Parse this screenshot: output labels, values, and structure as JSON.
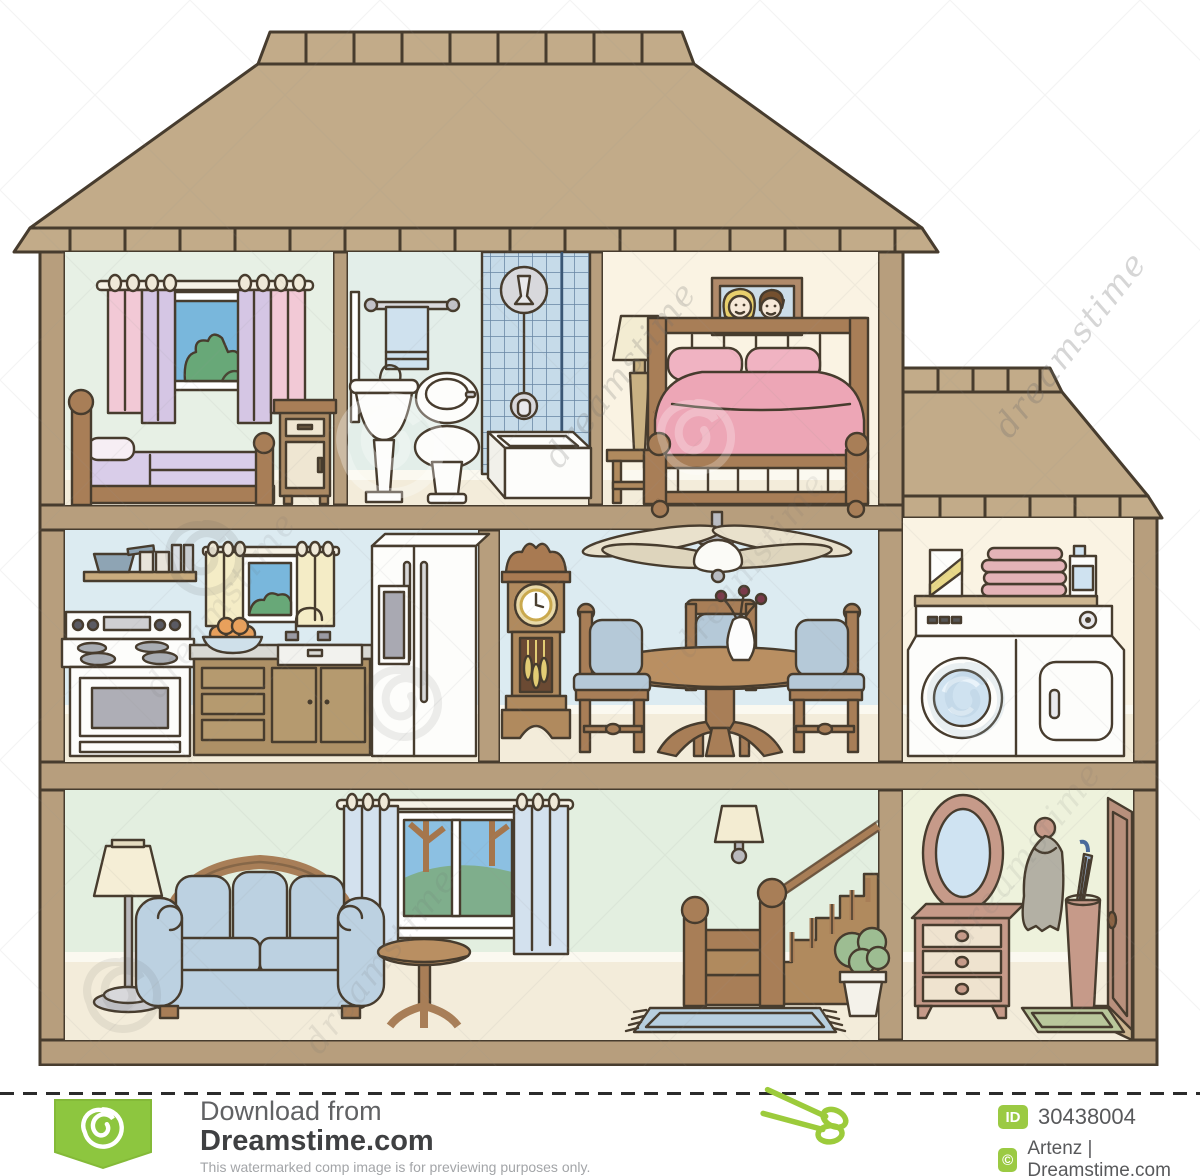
{
  "watermark": {
    "brand": "dreamstime",
    "logo": "spiral-swirl"
  },
  "footer": {
    "download_from": "Download from",
    "site": "Dreamstime.com",
    "disclaimer": "This watermarked comp image is for previewing purposes only.",
    "id_badge": "ID",
    "image_id": "30438004",
    "copyright_badge": "©",
    "credit": "Artenz | Dreamstime.com"
  },
  "illustration": {
    "subject": "house cross-section",
    "rooms": [
      {
        "name": "child-bedroom",
        "floor": "top",
        "items": [
          "window-with-curtains",
          "single-bed",
          "nightstand"
        ]
      },
      {
        "name": "bathroom",
        "floor": "top",
        "items": [
          "towel-rail",
          "pedestal-sink",
          "toilet",
          "shower",
          "bathtub"
        ]
      },
      {
        "name": "master-bedroom",
        "floor": "top",
        "items": [
          "portrait",
          "table-lamp",
          "double-bed"
        ]
      },
      {
        "name": "kitchen",
        "floor": "middle",
        "items": [
          "shelf",
          "window",
          "stove",
          "counter",
          "sink",
          "fruit-bowl",
          "refrigerator"
        ]
      },
      {
        "name": "dining-room",
        "floor": "middle",
        "items": [
          "grandfather-clock",
          "ceiling-fan",
          "dining-table",
          "chairs",
          "vase"
        ]
      },
      {
        "name": "laundry-room",
        "floor": "middle",
        "items": [
          "shelf",
          "detergent",
          "towels",
          "washer",
          "dryer"
        ]
      },
      {
        "name": "living-room",
        "floor": "bottom",
        "items": [
          "floor-lamp",
          "sofa",
          "side-table",
          "window",
          "wall-sconce"
        ]
      },
      {
        "name": "staircase-hall",
        "floor": "bottom",
        "items": [
          "staircase",
          "railing",
          "plant",
          "rug"
        ]
      },
      {
        "name": "entry-hall",
        "floor": "bottom",
        "items": [
          "oval-mirror",
          "dresser",
          "coat",
          "umbrella-stand",
          "door",
          "doormat"
        ]
      }
    ]
  },
  "colors": {
    "roof": "#c2ab89",
    "structure": "#b79e7d",
    "outline": "#473c2e",
    "floor": "#f3ecda",
    "accent_green": "#8dc63f",
    "bed_pink": "#eda6b6",
    "sofa_blue": "#bcd1e1",
    "wood": "#a87e57"
  }
}
